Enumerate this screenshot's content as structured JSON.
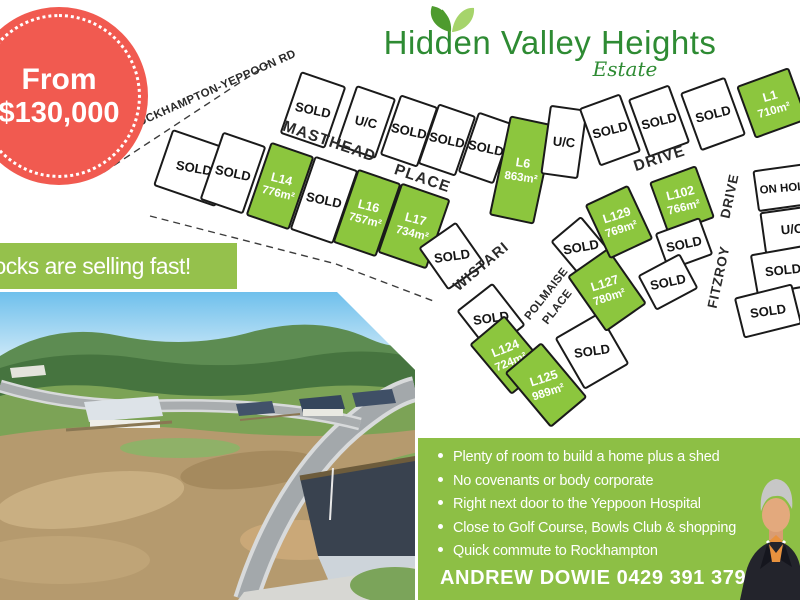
{
  "badge": {
    "prefix": "From",
    "price": "$130,000"
  },
  "title": {
    "name": "Hidden Valley Heights",
    "subtitle": "Estate"
  },
  "banner": {
    "text": "Blocks are selling fast!"
  },
  "map": {
    "colors": {
      "available": "#8cc63e",
      "sold_fill": "#ffffff",
      "line": "#1a1a1a"
    },
    "streets": [
      {
        "label": "ROCKHAMPTON-YEPPOON RD",
        "x": 214,
        "y": 93,
        "rot": -24,
        "size": 11.5,
        "ls": 0.4
      },
      {
        "label": "MASTHEAD",
        "x": 328,
        "y": 146,
        "rot": 19,
        "size": 15.5,
        "ls": 1.2
      },
      {
        "label": "PLACE",
        "x": 421,
        "y": 183,
        "rot": 19,
        "size": 15.5,
        "ls": 1.2
      },
      {
        "label": "DRIVE",
        "x": 661,
        "y": 163,
        "rot": -18,
        "size": 15.5,
        "ls": 1.2
      },
      {
        "label": "WISTARI",
        "x": 484,
        "y": 270,
        "rot": -40,
        "size": 14.5,
        "ls": 1
      },
      {
        "label": "POLMAISE",
        "x": 549,
        "y": 296,
        "rot": -52,
        "size": 11.5,
        "ls": 0.3
      },
      {
        "label": "PLACE",
        "x": 560,
        "y": 309,
        "rot": -52,
        "size": 11.5,
        "ls": 0.3
      },
      {
        "label": "FITZROY",
        "x": 723,
        "y": 278,
        "rot": -78,
        "size": 13.5,
        "ls": 0.8
      },
      {
        "label": "DRIVE",
        "x": 734,
        "y": 197,
        "rot": -78,
        "size": 13.5,
        "ls": 0.8
      }
    ],
    "boundaries": [
      {
        "points": "104,172 268,64",
        "dash": "7,5"
      },
      {
        "points": "150,216 336,264 436,302",
        "dash": "7,5"
      }
    ],
    "lots": [
      {
        "label": "SOLD",
        "status": "sold",
        "cx": 313,
        "cy": 110,
        "w": 46,
        "h": 64,
        "rot": 19,
        "lrot": 12
      },
      {
        "label": "U/C",
        "status": "uc",
        "cx": 366,
        "cy": 122,
        "w": 40,
        "h": 62,
        "rot": 19,
        "lrot": 12
      },
      {
        "label": "SOLD",
        "status": "sold",
        "cx": 409,
        "cy": 131,
        "w": 38,
        "h": 62,
        "rot": 19,
        "lrot": 12
      },
      {
        "label": "SOLD",
        "status": "sold",
        "cx": 447,
        "cy": 140,
        "w": 38,
        "h": 62,
        "rot": 19,
        "lrot": 12
      },
      {
        "label": "SOLD",
        "status": "sold",
        "cx": 486,
        "cy": 148,
        "w": 36,
        "h": 62,
        "rot": 19,
        "lrot": 12
      },
      {
        "label": "L6",
        "area": "863m²",
        "status": "available",
        "cx": 522,
        "cy": 170,
        "w": 44,
        "h": 100,
        "rot": 12,
        "lrot": 8
      },
      {
        "label": "U/C",
        "status": "uc",
        "cx": 564,
        "cy": 142,
        "w": 36,
        "h": 68,
        "rot": 8,
        "lrot": 5
      },
      {
        "label": "SOLD",
        "status": "sold",
        "cx": 610,
        "cy": 130,
        "w": 42,
        "h": 60,
        "rot": -20,
        "lrot": -14
      },
      {
        "label": "SOLD",
        "status": "sold",
        "cx": 659,
        "cy": 121,
        "w": 42,
        "h": 60,
        "rot": -20,
        "lrot": -14
      },
      {
        "label": "SOLD",
        "status": "sold",
        "cx": 713,
        "cy": 114,
        "w": 46,
        "h": 60,
        "rot": -20,
        "lrot": -14
      },
      {
        "label": "L1",
        "area": "710m²",
        "status": "available",
        "cx": 772,
        "cy": 103,
        "w": 54,
        "h": 54,
        "rot": -20,
        "lrot": -16
      },
      {
        "label": "SOLD",
        "status": "sold",
        "cx": 194,
        "cy": 168,
        "w": 64,
        "h": 58,
        "rot": 19,
        "lrot": 10
      },
      {
        "label": "SOLD",
        "status": "sold",
        "cx": 233,
        "cy": 173,
        "w": 44,
        "h": 70,
        "rot": 19,
        "lrot": 12
      },
      {
        "label": "L14",
        "area": "776m²",
        "status": "available",
        "cx": 280,
        "cy": 186,
        "w": 44,
        "h": 76,
        "rot": 19,
        "lrot": 14
      },
      {
        "label": "SOLD",
        "status": "sold",
        "cx": 324,
        "cy": 200,
        "w": 44,
        "h": 76,
        "rot": 19,
        "lrot": 12
      },
      {
        "label": "L16",
        "area": "757m²",
        "status": "available",
        "cx": 367,
        "cy": 213,
        "w": 44,
        "h": 76,
        "rot": 19,
        "lrot": 14
      },
      {
        "label": "L17",
        "area": "734m²",
        "status": "available",
        "cx": 414,
        "cy": 226,
        "w": 50,
        "h": 72,
        "rot": 19,
        "lrot": 14
      },
      {
        "label": "SOLD",
        "status": "sold",
        "cx": 452,
        "cy": 256,
        "w": 44,
        "h": 50,
        "rot": -35,
        "lrot": -8
      },
      {
        "label": "SOLD",
        "status": "sold",
        "cx": 491,
        "cy": 318,
        "w": 44,
        "h": 52,
        "rot": -38,
        "lrot": -8
      },
      {
        "label": "SOLD",
        "status": "sold",
        "cx": 581,
        "cy": 247,
        "w": 38,
        "h": 46,
        "rot": -40,
        "lrot": -10
      },
      {
        "label": "SOLD",
        "status": "sold",
        "cx": 592,
        "cy": 351,
        "w": 50,
        "h": 58,
        "rot": -30,
        "lrot": -8
      },
      {
        "label": "L124",
        "area": "724m²",
        "status": "available",
        "cx": 508,
        "cy": 355,
        "w": 44,
        "h": 64,
        "rot": -40,
        "lrot": -22
      },
      {
        "label": "L125",
        "area": "989m²",
        "status": "available",
        "cx": 546,
        "cy": 385,
        "w": 46,
        "h": 70,
        "rot": -40,
        "lrot": -18
      },
      {
        "label": "L127",
        "area": "780m²",
        "status": "available",
        "cx": 607,
        "cy": 290,
        "w": 48,
        "h": 66,
        "rot": -35,
        "lrot": -18
      },
      {
        "label": "L129",
        "area": "769m²",
        "status": "available",
        "cx": 619,
        "cy": 222,
        "w": 46,
        "h": 58,
        "rot": -25,
        "lrot": -18
      },
      {
        "label": "L102",
        "area": "766m²",
        "status": "available",
        "cx": 682,
        "cy": 200,
        "w": 48,
        "h": 54,
        "rot": -20,
        "lrot": -14
      },
      {
        "label": "SOLD",
        "status": "sold",
        "cx": 684,
        "cy": 244,
        "w": 46,
        "h": 38,
        "rot": -20,
        "lrot": -12
      },
      {
        "label": "SOLD",
        "status": "sold",
        "cx": 668,
        "cy": 282,
        "w": 46,
        "h": 38,
        "rot": -28,
        "lrot": -12
      },
      {
        "label": "ON HOLD",
        "status": "on_hold",
        "cx": 786,
        "cy": 187,
        "w": 60,
        "h": 40,
        "rot": -8,
        "lrot": -5,
        "fs": 11.5
      },
      {
        "label": "U/C",
        "status": "uc",
        "cx": 792,
        "cy": 229,
        "w": 58,
        "h": 40,
        "rot": -8,
        "lrot": -5
      },
      {
        "label": "SOLD",
        "status": "sold",
        "cx": 783,
        "cy": 270,
        "w": 58,
        "h": 40,
        "rot": -10,
        "lrot": -6
      },
      {
        "label": "SOLD",
        "status": "sold",
        "cx": 768,
        "cy": 311,
        "w": 58,
        "h": 40,
        "rot": -14,
        "lrot": -8
      }
    ]
  },
  "features": {
    "bullets": [
      "Plenty of room to build a home plus a shed",
      "No covenants or body corporate",
      "Right next door to the Yeppoon Hospital",
      "Close to Golf Course, Bowls Club & shopping",
      "Quick commute to Rockhampton"
    ],
    "agent": "ANDREW DOWIE 0429 391 379"
  },
  "colors": {
    "badge_red": "#f15a50",
    "title_green": "#2e8b33",
    "banner_green": "#95c14c",
    "box_green": "#8dbf45",
    "lot_green": "#8cc63e"
  }
}
